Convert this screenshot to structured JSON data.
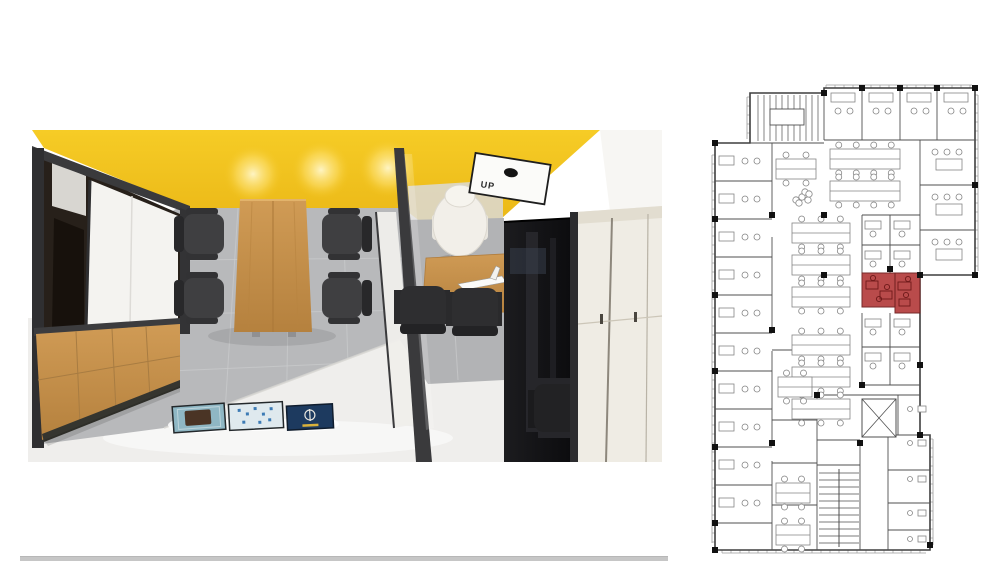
{
  "page": {
    "background": "#ffffff"
  },
  "render": {
    "description": "top-down 3d render of meeting room and private office",
    "ceiling_panel_label": "UP",
    "colors": {
      "ceiling_yellow": "#f2c41c",
      "frame_dark": "#3a3a3c",
      "wood": "#c8914b",
      "wood_dark": "#b07a38",
      "floor_tile": "#b8b9bb",
      "tile_joint": "#cdcecf",
      "floor_light": "#efeeec",
      "wall_white": "#f4f3f0",
      "closet_cream": "#efece4",
      "cabinet_black": "#151517",
      "chair_dark": "#3f3f41",
      "chair_white": "#f2efe9",
      "shadow_strip": "#c6c6c6"
    },
    "posters": [
      {
        "name": "poster-teal-artwork",
        "bg": "#8fb7c4",
        "motif": "#4a3425"
      },
      {
        "name": "poster-light-grid",
        "bg": "#dfe9ee",
        "motif": "#3d7bb5"
      },
      {
        "name": "poster-navy-emblem",
        "bg": "#1d3a5f",
        "motif": "#e8e6df",
        "accent": "#d9b13b"
      }
    ]
  },
  "plan": {
    "line_color": "#4f4f4f",
    "outline_color": "#3f3f3f",
    "furniture_color": "#858585",
    "window_color": "#9a9a9a",
    "column_color": "#111111",
    "highlight_color": "#b64242",
    "highlight_stroke": "#6f1f1f",
    "highlight_furniture": "#6e1a1a",
    "outline": "M38,8 H112 V3 H263 V190 H208 V350 H218 V465 H3 V58 H38 Z",
    "highlight_rooms": [
      {
        "x": 150,
        "y": 188,
        "w": 33,
        "h": 34
      },
      {
        "x": 183,
        "y": 188,
        "w": 25,
        "h": 40
      }
    ],
    "red_furniture_rects": [
      [
        154,
        196,
        12,
        8
      ],
      [
        168,
        206,
        12,
        8
      ],
      [
        186,
        197,
        13,
        8
      ],
      [
        187,
        214,
        11,
        7
      ]
    ],
    "red_furniture_chairs": [
      [
        161,
        193
      ],
      [
        175,
        202
      ],
      [
        167,
        214
      ],
      [
        196,
        194
      ],
      [
        194,
        210
      ]
    ],
    "walls": [
      [
        3,
        96,
        60,
        96
      ],
      [
        3,
        134,
        60,
        134
      ],
      [
        3,
        172,
        60,
        172
      ],
      [
        3,
        210,
        60,
        210
      ],
      [
        3,
        248,
        60,
        248
      ],
      [
        3,
        286,
        60,
        286
      ],
      [
        3,
        324,
        60,
        324
      ],
      [
        3,
        362,
        60,
        362
      ],
      [
        3,
        400,
        60,
        400
      ],
      [
        3,
        438,
        60,
        438
      ],
      [
        60,
        58,
        60,
        132
      ],
      [
        60,
        152,
        60,
        242
      ],
      [
        60,
        266,
        60,
        356
      ],
      [
        60,
        376,
        60,
        465
      ],
      [
        38,
        58,
        112,
        58
      ],
      [
        112,
        8,
        112,
        55
      ],
      [
        112,
        55,
        263,
        55
      ],
      [
        150,
        3,
        150,
        55
      ],
      [
        188,
        3,
        188,
        55
      ],
      [
        225,
        3,
        225,
        55
      ],
      [
        208,
        55,
        208,
        190
      ],
      [
        208,
        100,
        263,
        100
      ],
      [
        208,
        145,
        263,
        145
      ],
      [
        150,
        130,
        208,
        130
      ],
      [
        150,
        130,
        150,
        188
      ],
      [
        178,
        130,
        178,
        188
      ],
      [
        150,
        160,
        208,
        160
      ],
      [
        150,
        228,
        150,
        300
      ],
      [
        178,
        228,
        178,
        300
      ],
      [
        150,
        262,
        208,
        262
      ],
      [
        150,
        300,
        208,
        300
      ],
      [
        105,
        310,
        105,
        465
      ],
      [
        105,
        310,
        208,
        310
      ],
      [
        148,
        355,
        148,
        465
      ],
      [
        105,
        355,
        148,
        355
      ],
      [
        105,
        380,
        148,
        380
      ],
      [
        176,
        350,
        218,
        350
      ],
      [
        176,
        350,
        176,
        465
      ],
      [
        176,
        385,
        218,
        385
      ],
      [
        176,
        418,
        218,
        418
      ],
      [
        176,
        445,
        218,
        445
      ],
      [
        186,
        310,
        186,
        350
      ],
      [
        60,
        265,
        105,
        265
      ],
      [
        60,
        335,
        105,
        335
      ],
      [
        60,
        378,
        105,
        378
      ],
      [
        60,
        420,
        105,
        420
      ]
    ],
    "windows": [
      [
        3,
        70,
        3,
        458,
        -1,
        0
      ],
      [
        114,
        3,
        260,
        3,
        0,
        -1
      ],
      [
        263,
        10,
        263,
        186,
        1,
        0
      ],
      [
        10,
        465,
        214,
        465,
        0,
        1
      ],
      [
        218,
        354,
        218,
        460,
        1,
        0
      ],
      [
        38,
        12,
        38,
        54,
        -1,
        0
      ]
    ],
    "columns": [
      [
        3,
        58
      ],
      [
        3,
        134
      ],
      [
        3,
        210
      ],
      [
        3,
        286
      ],
      [
        3,
        362
      ],
      [
        3,
        438
      ],
      [
        3,
        465
      ],
      [
        60,
        130
      ],
      [
        60,
        245
      ],
      [
        60,
        358
      ],
      [
        112,
        8
      ],
      [
        150,
        3
      ],
      [
        188,
        3
      ],
      [
        225,
        3
      ],
      [
        263,
        3
      ],
      [
        263,
        100
      ],
      [
        263,
        190
      ],
      [
        208,
        190
      ],
      [
        208,
        280
      ],
      [
        208,
        350
      ],
      [
        218,
        460
      ],
      [
        148,
        358
      ],
      [
        105,
        310
      ],
      [
        112,
        130
      ],
      [
        150,
        300
      ],
      [
        178,
        184
      ],
      [
        112,
        190
      ]
    ],
    "benches": [
      [
        118,
        64,
        70
      ],
      [
        118,
        96,
        70
      ],
      [
        80,
        138,
        58
      ],
      [
        80,
        170,
        58
      ],
      [
        80,
        202,
        58
      ],
      [
        80,
        250,
        58
      ],
      [
        80,
        282,
        58
      ],
      [
        80,
        314,
        58
      ],
      [
        64,
        74,
        40
      ],
      [
        66,
        292,
        34
      ],
      [
        64,
        398,
        34
      ],
      [
        64,
        440,
        34
      ]
    ],
    "left_rooms_y": [
      58,
      96,
      134,
      172,
      210,
      248,
      286,
      324,
      362,
      400
    ],
    "top_rooms_x": [
      114,
      152,
      190,
      227
    ],
    "right_rooms_y": [
      57,
      102,
      147
    ],
    "small_desks": [
      [
        153,
        136
      ],
      [
        182,
        136
      ],
      [
        153,
        166
      ],
      [
        182,
        166
      ],
      [
        153,
        234
      ],
      [
        182,
        234
      ],
      [
        153,
        268
      ],
      [
        182,
        268
      ]
    ],
    "plant": {
      "x": 90,
      "y": 112
    },
    "stair_top": {
      "x": 40,
      "y": 10,
      "w": 70,
      "h": 46
    },
    "stair_core": {
      "x": 107,
      "y": 384,
      "w": 40,
      "h": 78
    },
    "elevator": {
      "x": 150,
      "y": 314,
      "w": 34,
      "h": 38
    },
    "restroom_rows_y": [
      318,
      352,
      388,
      422,
      448
    ]
  }
}
